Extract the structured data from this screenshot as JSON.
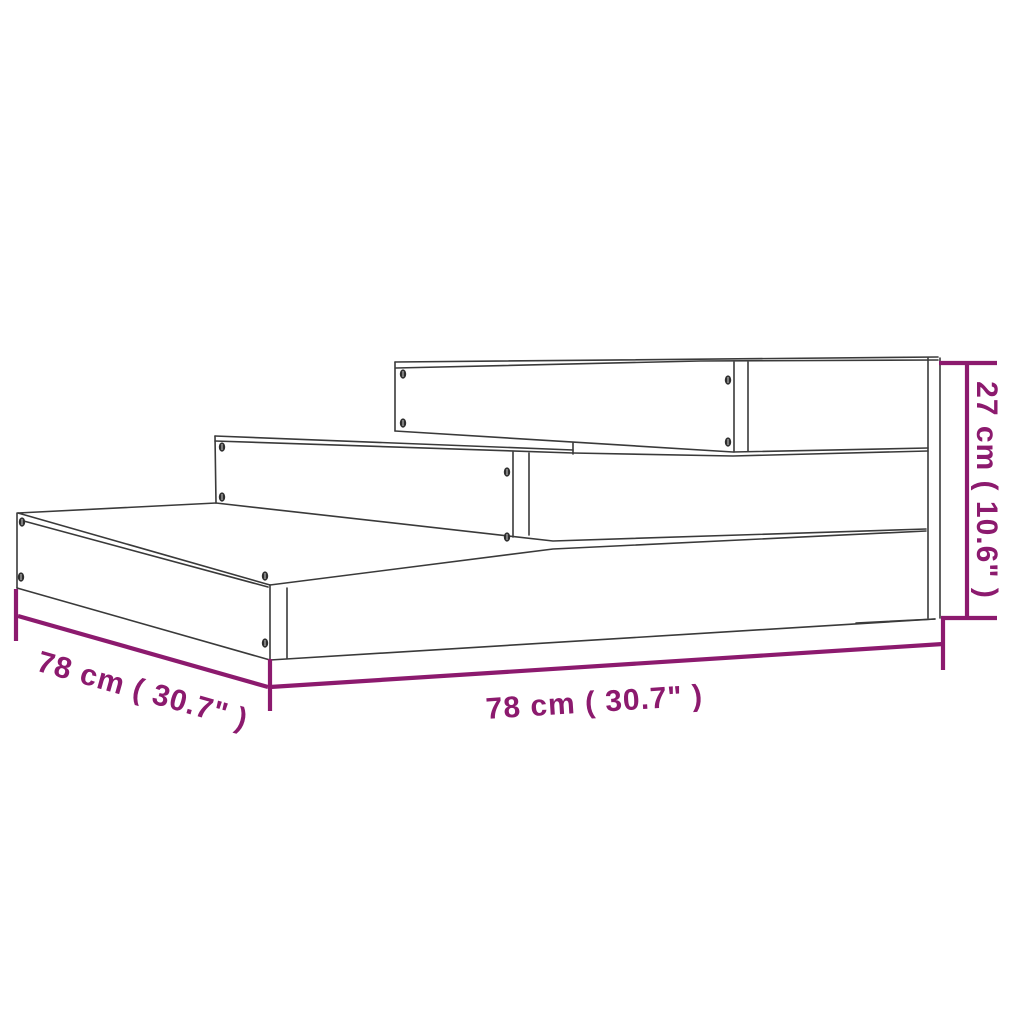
{
  "diagram": {
    "labels": {
      "front_width": "78 cm ( 30.7\" )",
      "side_depth": "78 cm ( 30.7\" )",
      "height": "27 cm ( 10.6\" )"
    },
    "colors": {
      "dimension": "#8C1A6E",
      "line": "#3A3A3A",
      "background": "#FFFFFF"
    }
  }
}
